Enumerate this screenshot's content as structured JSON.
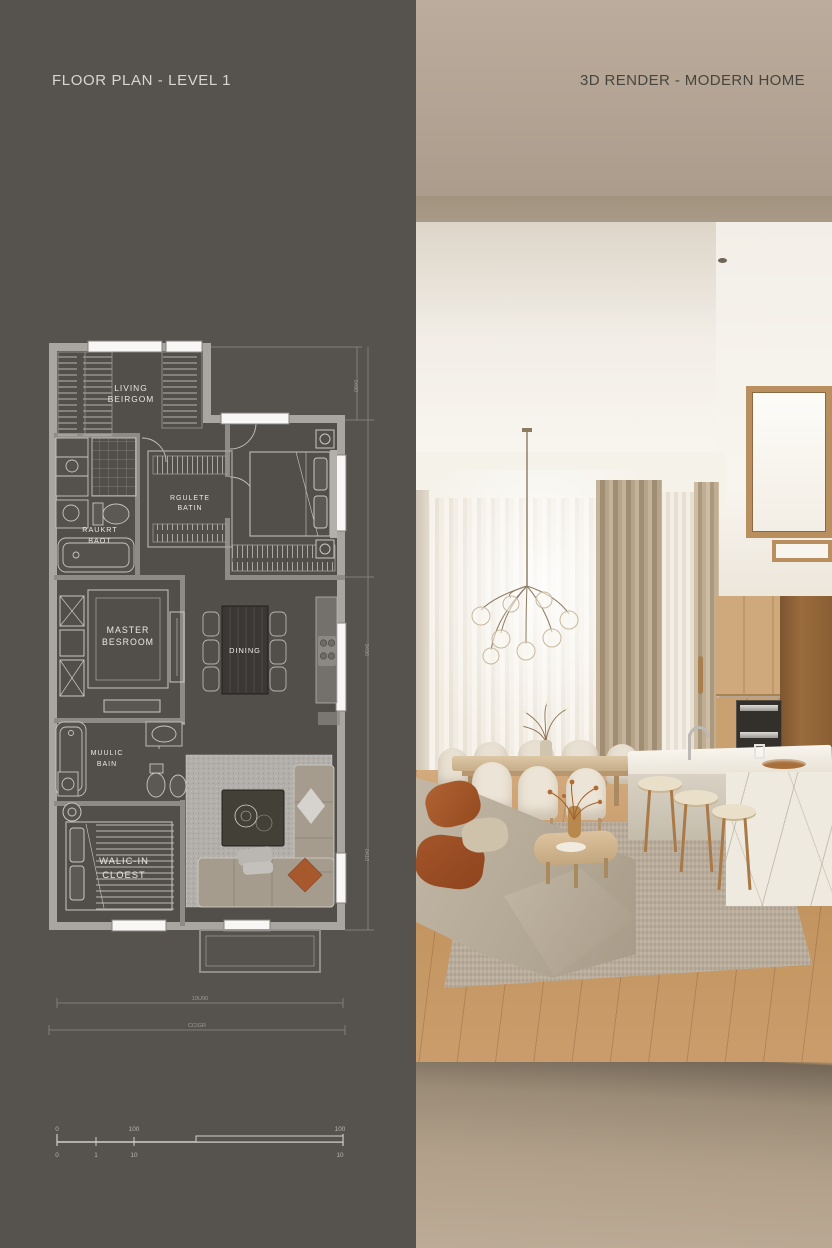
{
  "left_panel": {
    "title": "FLOOR PLAN - LEVEL 1",
    "rooms": {
      "living": {
        "line1": "LIVING",
        "line2": "BEIRGOM"
      },
      "wardrobe": {
        "line1": "RGULETE",
        "line2": "BATIN"
      },
      "bath1": {
        "line1": "RAUKRT",
        "line2": "BAOT"
      },
      "master": {
        "line1": "MASTER",
        "line2": "BESROOM"
      },
      "dining": {
        "label": "DINING"
      },
      "bath2": {
        "line1": "MUULIC",
        "line2": "BAIN"
      },
      "walkin": {
        "line1": "WALIC-IN",
        "line2": "CLOEST"
      }
    },
    "dimensions": {
      "right_top": "0490",
      "right_mid": "9490",
      "right_bottom": "0410",
      "bottom_inner": "10U90",
      "bottom_outer": "CCIGR"
    },
    "scale_bar": {
      "top_labels": [
        "0",
        "100",
        "100"
      ],
      "bottom_labels": [
        "0",
        "1",
        "10",
        "10"
      ]
    },
    "colors": {
      "background": "#56534f",
      "wall": "#a9a6a2",
      "window_glass": "#f8f7f5",
      "living_rug": "#b2afaa",
      "accent_pillow": "#a8582d"
    }
  },
  "right_panel": {
    "title": "3D RENDER - MODERN HOME",
    "colors": {
      "wall_beige": "#b3a495",
      "ceiling_white": "#f4f1ea",
      "curtain_sheer": "#f0ebe1",
      "drape_taupe": "#b1a086",
      "wood_floor": "#c79a6b",
      "cabinet_oak": "#c8a172",
      "island_marble": "#efeadf",
      "sofa_beige": "#b1a492",
      "pillow_rust": "#a8582d"
    }
  }
}
